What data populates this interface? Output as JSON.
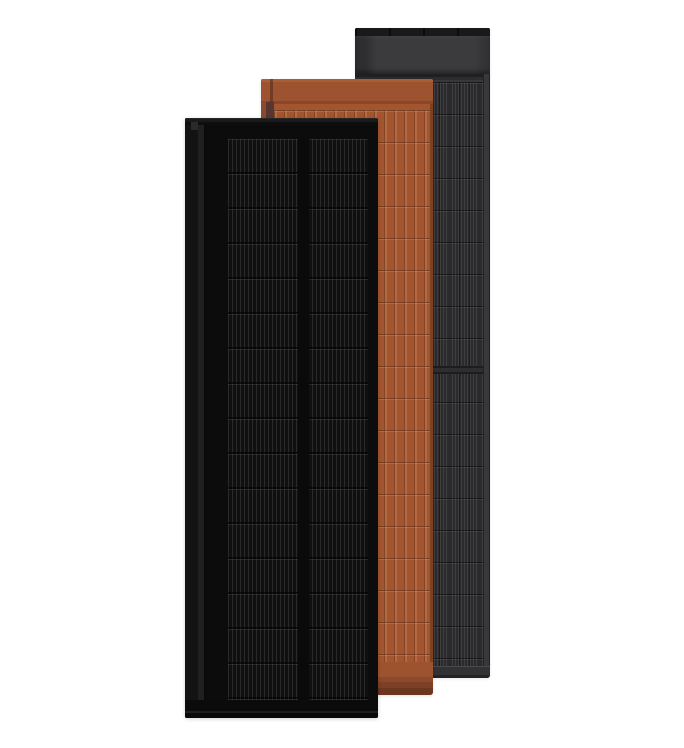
{
  "scene": {
    "description": "Product render of three overlapping tall rectangular solar roof panels on a white background, no text or UI controls visible",
    "background_color": "#ffffff"
  },
  "colors": {
    "bg": "#ffffff",
    "black-frame": "#0c0c0c",
    "black-cell": "#101010",
    "terra-base": "#a2552f",
    "terra-dark": "#573632",
    "terra-deep": "#6b371f",
    "gray-header": "#3b3b3d",
    "gray-cell": "#2b2b2d",
    "gray-bar": "#19191b"
  },
  "panels": [
    {
      "id": "black",
      "label": "Black solar panel (front left)",
      "frame_color": "#0c0c0c",
      "cell_color": "#101010",
      "busbar_line_color": "#2f2f2f",
      "cell_columns": 2
    },
    {
      "id": "terracotta",
      "label": "Terracotta solar roof panel (middle)",
      "base_color": "#a2552f",
      "left_edge_color": "#573632",
      "bottom_shade_color": "#6b371f"
    },
    {
      "id": "charcoal",
      "label": "Charcoal gray solar roof panel (back right)",
      "header_color": "#3b3b3d",
      "cell_color": "#2b2b2d",
      "top_bar_color": "#19191b"
    }
  ]
}
